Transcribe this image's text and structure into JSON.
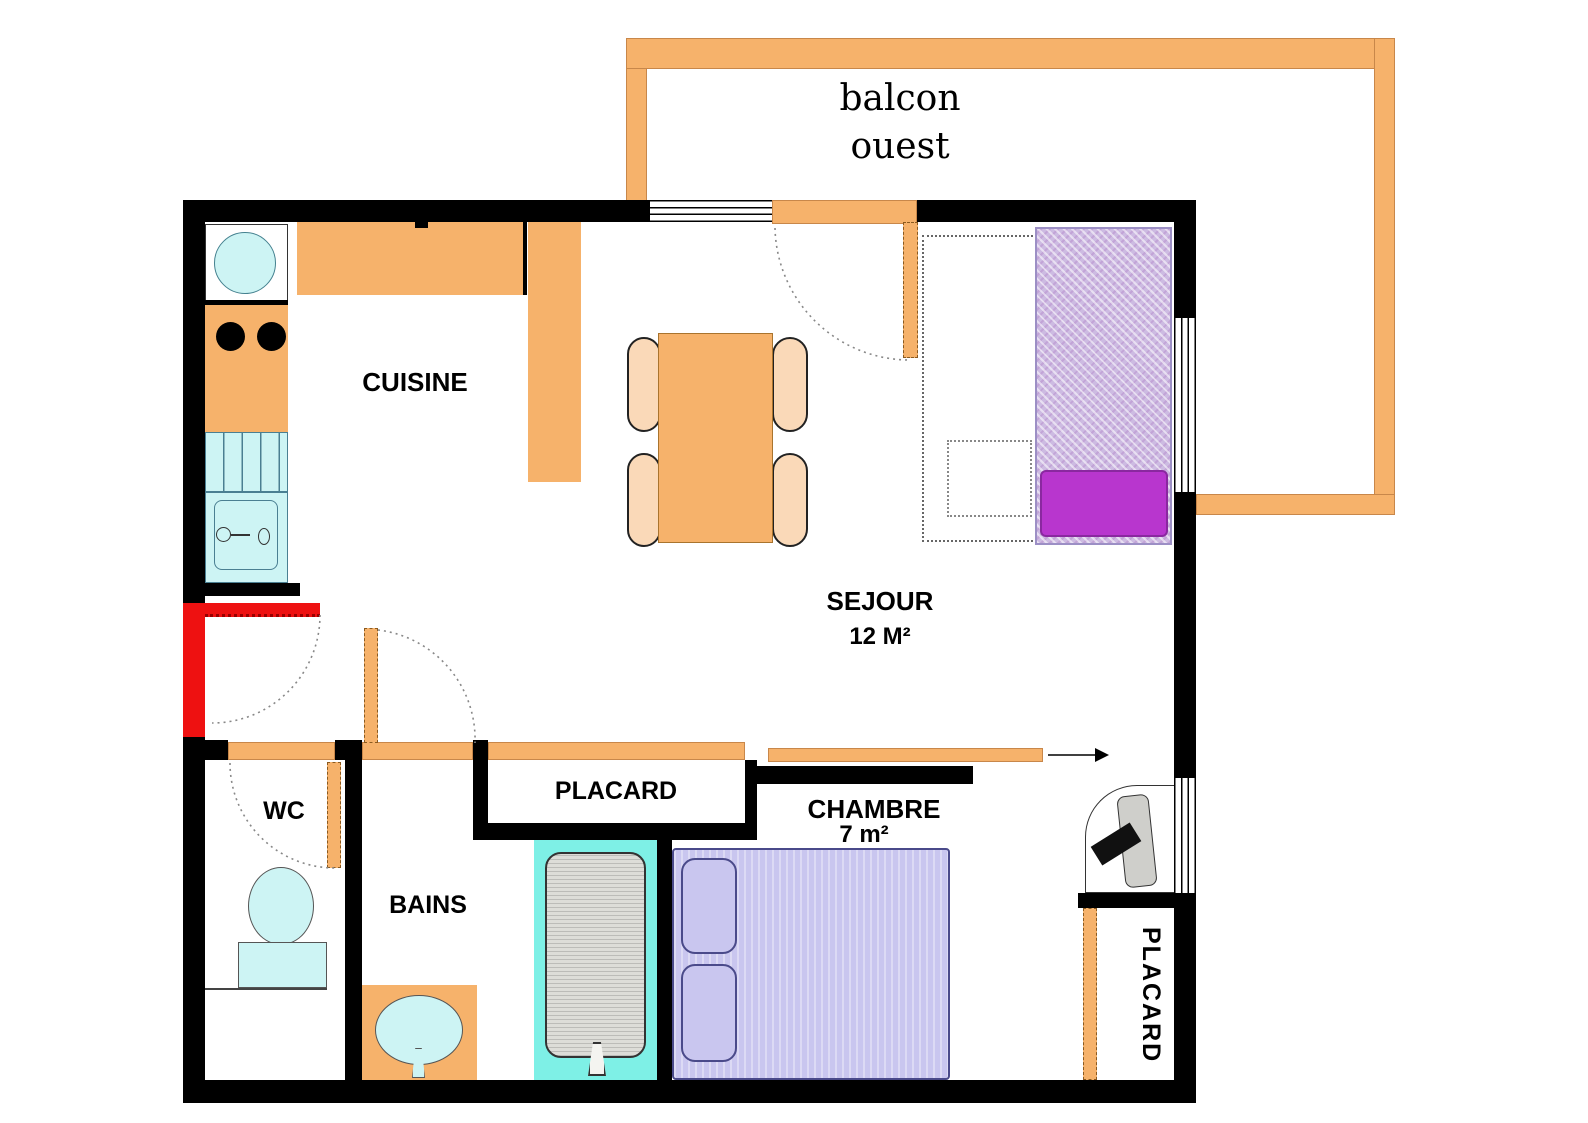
{
  "plan": {
    "title": "apartment floor plan",
    "type": "floor-plan"
  },
  "labels": {
    "balcon": "balcon",
    "ouest": "ouest",
    "cuisine": "CUISINE",
    "sejour": "SEJOUR",
    "sejour_area": "12 M²",
    "wc": "WC",
    "bains": "BAINS",
    "placard_hall": "PLACARD",
    "chambre": "CHAMBRE",
    "chambre_area": "7 m²",
    "placard_chambre": "PLACARD"
  },
  "colors": {
    "wall": "#000000",
    "furniture_orange": "#F6B26B",
    "chair_peach": "#FAD9B8",
    "fixture_cyan": "#CDF4F4",
    "tub_cyan": "#7EF0E6",
    "bed_lavender": "#C9C6EF",
    "sofa_lilac": "#CDBBE2",
    "cushion_magenta": "#B836CE",
    "entry_red": "#EE1111",
    "tub_gray": "#DDDDD8"
  }
}
